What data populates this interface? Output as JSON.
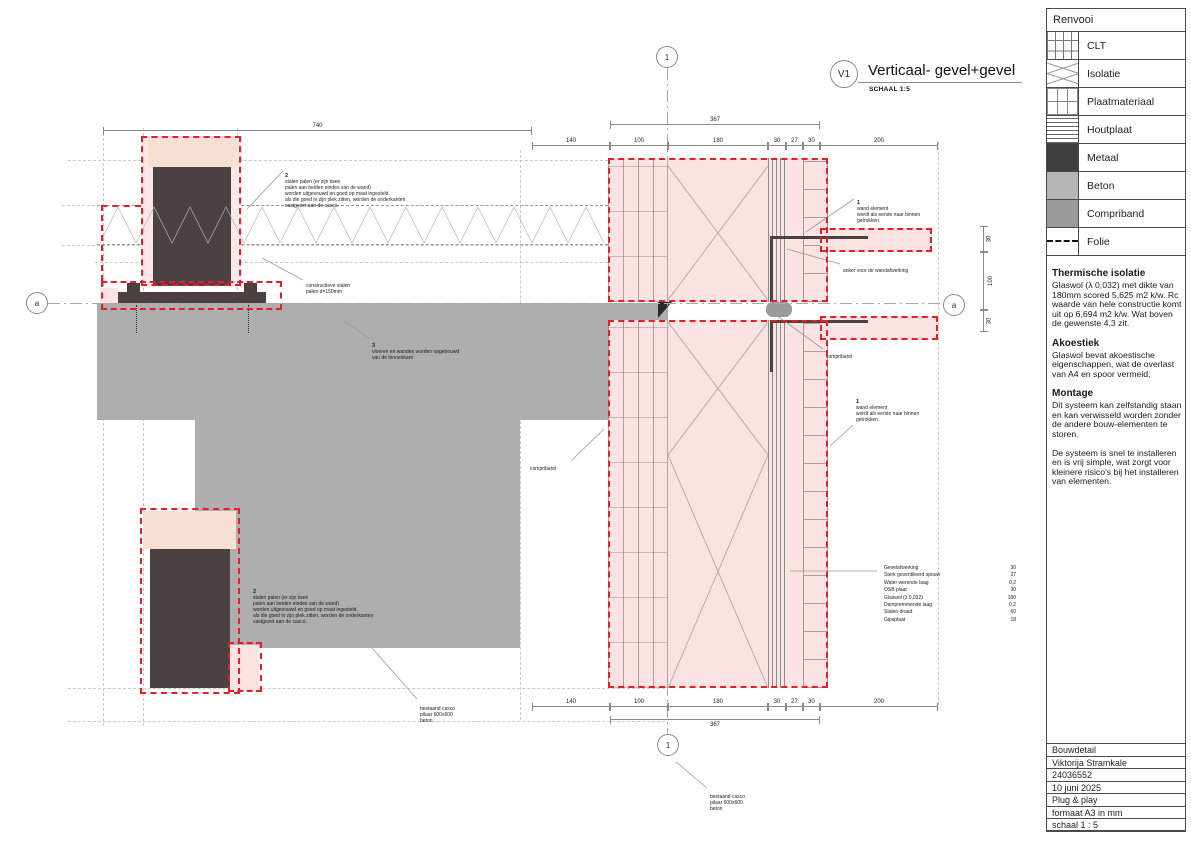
{
  "view": {
    "tag": "V1",
    "title": "Verticaal- gevel+gevel",
    "scale_label": "SCHAAL 1:5"
  },
  "legend": {
    "title": "Renvooi",
    "items": [
      {
        "label": "CLT"
      },
      {
        "label": "Isolatie"
      },
      {
        "label": "Plaatmateriaal"
      },
      {
        "label": "Houtplaat"
      },
      {
        "label": "Metaal",
        "color": "#3f3f3f"
      },
      {
        "label": "Beton",
        "color": "#b5b5b5"
      },
      {
        "label": "Compriband",
        "color": "#9b9b9b"
      },
      {
        "label": "Folie"
      }
    ]
  },
  "notes_panel": {
    "sections": [
      {
        "heading": "Thermische isolatie",
        "body": "Glaswol (λ 0,032) met dikte van 180mm scored 5,625 m2 k/w. Rc waarde van hele constructie komt uit op 6,694 m2 k/w. Wat boven de gewenste 4,3 zit."
      },
      {
        "heading": "Akoestiek",
        "body": "Glaswol bevat akoestische eigenschappen, wat de overlast van A4 en spoor vermeid."
      },
      {
        "heading": "Montage",
        "body": "Dit systeem kan zelfstandig staan en kan verwisseld worden zonder de andere bouw-elementen te storen.\n\nDe systeem is snel te installeren en is vrij simple, wat zorgt voor kleinere risico's bij het installeren van elementen."
      }
    ]
  },
  "title_block": {
    "rows": [
      "Bouwdetail",
      "Viktorija Stramkale",
      "24036552",
      "10 juni 2025",
      "Plug & play",
      "formaat A3 in mm",
      "schaal 1 : 5"
    ]
  },
  "markers": {
    "section_top": "1",
    "section_bottom": "1",
    "axis_left": "a",
    "axis_right": "a"
  },
  "annotations": {
    "steel_posts_top": {
      "num": "2",
      "body": "stalen palen (er zijn twee\npalen aan beiden eindes van de wand)\nworden uitgevouwd en goed op maat ingesteld.\nals die goed in zijn plek zitten, worden de onderkanten\nvastgezet aan de casco."
    },
    "steel_posts_bottom": {
      "num": "2",
      "body": "stalen palen (er zijn twee\npalen aan beiden eindes van de wand)\nworden uitgevouwd en goed op maat ingesteld.\nals die goed in zijn plek zitten, worden de onderkanten\nvastgezet aan de casco."
    },
    "constructieve": "constructieve stalen\npalen d=150mm",
    "floors": {
      "num": "3",
      "body": "vloeren en wanden worden opgebouwd\nvan de binnenkant"
    },
    "wall_element_top": {
      "num": "1",
      "body": "wand element\nwordt als eerste naar binnen\ngetrokken."
    },
    "wall_element_bottom": {
      "num": "1",
      "body": "wand element\nwordt als eerste naar binnen\ngetrokken."
    },
    "anker": "anker voor de wandafwerking",
    "compriband_right": "compriband",
    "compriband_left": "compriband",
    "bestaand_casco_left": "bestaand casco\npilaar 600x600\nbeton",
    "bestaand_casco_bottom": "bestaand casco\npilaar 600x600\nbeton"
  },
  "layer_table": {
    "rows": [
      {
        "name": "Gevelafwerking",
        "value": "30"
      },
      {
        "name": "Sterk geventileerd spouw",
        "value": "27"
      },
      {
        "name": "Water werende laag",
        "value": "0,2"
      },
      {
        "name": "OSB plaat",
        "value": "30"
      },
      {
        "name": "Glaswol (λ 0,032)",
        "value": "180"
      },
      {
        "name": "Dampremmende laag",
        "value": "0,2"
      },
      {
        "name": "Stalen draad",
        "value": "60"
      },
      {
        "name": "Gipsplaat",
        "value": "18"
      }
    ]
  },
  "dimensions": {
    "top_740": "740",
    "top_367": "367",
    "top_row": [
      "140",
      "100",
      "180",
      "30",
      "27",
      "30",
      "200"
    ],
    "bottom_row": [
      "140",
      "100",
      "180",
      "30",
      "27",
      "30",
      "200"
    ],
    "bottom_367": "367",
    "right_col": [
      "30",
      "100",
      "30"
    ]
  },
  "colors": {
    "red_dash": "#e61e2b",
    "pink_fill": "#fae3e2",
    "peach_fill": "#f8dfd3",
    "metal_dark": "#4a4140",
    "concrete": "#aeaeae",
    "compriband_gray": "#9b9b9b"
  }
}
